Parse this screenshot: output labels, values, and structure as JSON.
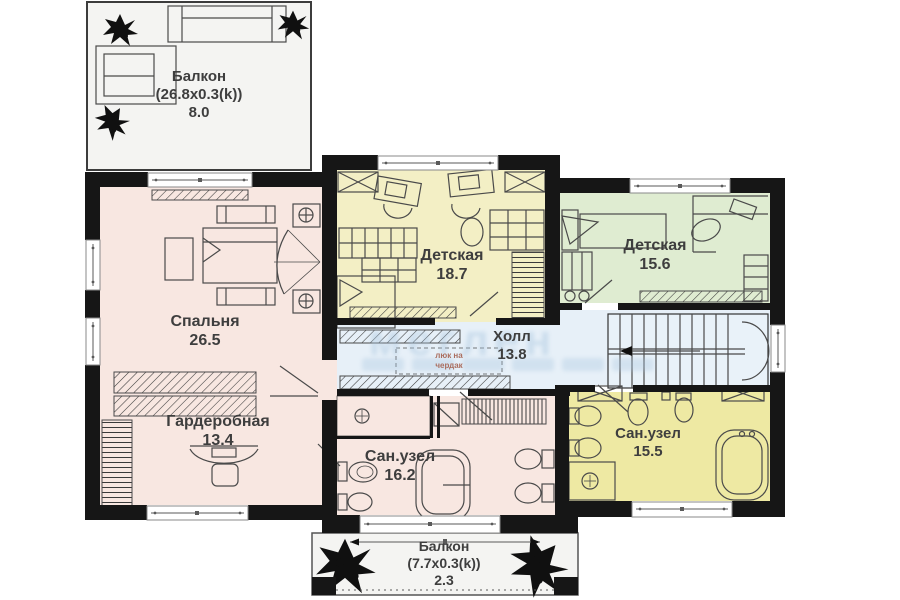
{
  "rooms": {
    "balcony_top": {
      "name": "Балкон",
      "dims": "(26.8x0.3(k))",
      "area": "8.0"
    },
    "bedroom": {
      "name": "Спальня",
      "area": "26.5"
    },
    "kids1": {
      "name": "Детская",
      "area": "18.7"
    },
    "kids2": {
      "name": "Детская",
      "area": "15.6"
    },
    "hall": {
      "name": "Холл",
      "area": "13.8"
    },
    "wardrobe": {
      "name": "Гардеробная",
      "area": "13.4"
    },
    "bath1": {
      "name": "Сан.узел",
      "area": "16.2"
    },
    "bath2": {
      "name": "Сан.узел",
      "area": "15.5"
    },
    "balcony_bottom": {
      "name": "Балкон",
      "dims": "(7.7x0.3(k))",
      "area": "2.3"
    }
  },
  "annotations": {
    "attic_hatch": [
      "люк на",
      "чердак"
    ]
  },
  "watermark": "меглен",
  "colors": {
    "wall": "#161616",
    "bedroom": "#f8e7e1",
    "kids1": "#f3efc5",
    "kids2": "#dfecd1",
    "hall": "#e7f0f8",
    "bath2": "#eee9a3",
    "balcony": "#f4f4f2",
    "stair": "#e9f2f9",
    "label": "#3e3e3e",
    "line": "#4a4a4a",
    "watermark": "#a9c6df",
    "attictext": "#aa6d5e",
    "winframe": "#8a8a8a"
  }
}
